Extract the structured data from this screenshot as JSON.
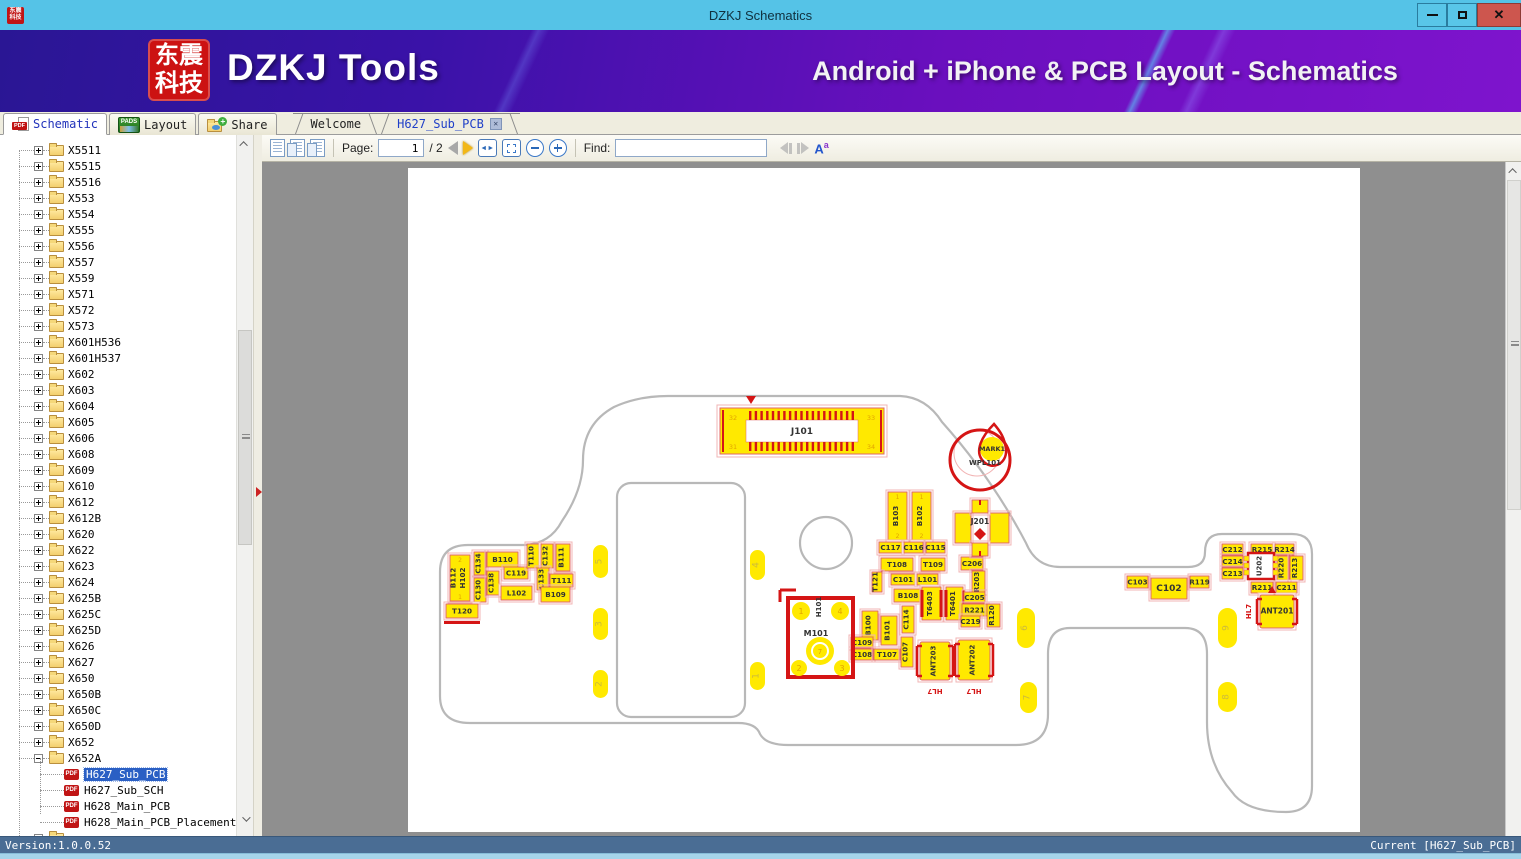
{
  "window": {
    "title": "DZKJ Schematics",
    "logo_line1": "东震",
    "logo_line2": "科技"
  },
  "banner": {
    "app_name": "DZKJ Tools",
    "tagline": "Android + iPhone & PCB Layout - Schematics"
  },
  "icons": {
    "pdf_badge": "PDF",
    "pads_badge": "PADS"
  },
  "tabs": {
    "app": [
      {
        "label": "Schematic",
        "active": true
      },
      {
        "label": "Layout",
        "active": false
      },
      {
        "label": "Share",
        "active": false
      }
    ],
    "docs": [
      {
        "label": "Welcome",
        "active": false,
        "closable": false
      },
      {
        "label": "H627_Sub_PCB",
        "active": true,
        "closable": true
      }
    ]
  },
  "toolbar": {
    "page_label": "Page:",
    "page_value": "1",
    "page_total": "/ 2",
    "find_label": "Find:",
    "find_value": ""
  },
  "sidebar": {
    "folders": [
      "X5511",
      "X5515",
      "X5516",
      "X553",
      "X554",
      "X555",
      "X556",
      "X557",
      "X559",
      "X571",
      "X572",
      "X573",
      "X601H536",
      "X601H537",
      "X602",
      "X603",
      "X604",
      "X605",
      "X606",
      "X608",
      "X609",
      "X610",
      "X612",
      "X612B",
      "X620",
      "X622",
      "X623",
      "X624",
      "X625B",
      "X625C",
      "X625D",
      "X626",
      "X627",
      "X650",
      "X650B",
      "X650C",
      "X650D",
      "X652",
      "X652A"
    ],
    "expanded": "X652A",
    "files": [
      {
        "label": "H627_Sub_PCB",
        "selected": true
      },
      {
        "label": "H627_Sub_SCH",
        "selected": false
      },
      {
        "label": "H628_Main_PCB",
        "selected": false
      },
      {
        "label": "H628_Main_PCB_Placement",
        "selected": false
      }
    ],
    "partial_folder": true
  },
  "statusbar": {
    "left": "Version:1.0.0.52",
    "right": "Current [H627_Sub_PCB]"
  },
  "pcb": {
    "colors": {
      "yellow": "#ffe900",
      "pink": "#e06666",
      "frame": "#f2b4b4",
      "red": "#d51515",
      "text": "#333333",
      "orange": "#e2a400",
      "board": "#b8b8b8",
      "tp_text": "#cdbb3a"
    },
    "outline": {
      "board": "M260,228 H492 Q518,229 534,254 Q584,310 618,375 Q628,399 652,399 H780 Q797,399 797,384 Q797,366 814,366 H884 Q904,366 904,386 V618 Q904,644 878,644 Q838,644 824,624 Q799,596 799,554 V486 Q799,460 777,460 H662 Q640,460 640,486 V546 Q640,577 608,577 H380 Q358,577 352,566 Q348,555 330,555 H62 Q32,555 32,528 V404 Q32,377 60,377 H116 Q142,376 154,353 Q175,322 175,292 Q175,256 206,239 Q230,228 260,228 Z",
      "slot": {
        "x": 209,
        "y": 315,
        "w": 128,
        "h": 234,
        "r": 14
      },
      "hole": {
        "cx": 418,
        "cy": 375,
        "r": 26
      }
    },
    "j101": {
      "label": "J101",
      "pins": [
        "32",
        "33",
        "31",
        "34"
      ],
      "x": 312,
      "y": 240,
      "w": 164,
      "h": 46
    },
    "mark": {
      "line1": "MARK1",
      "line2": "WPL101",
      "cx": 572,
      "cy": 292,
      "r": 30
    },
    "j201": {
      "label": "J201",
      "cx": 572,
      "cy": 359
    },
    "m101": {
      "label": "M101",
      "sub": "H101",
      "x": 380,
      "y": 430,
      "w": 65,
      "h": 79,
      "pads": [
        "1",
        "4",
        "2",
        "3"
      ],
      "center_pad": "7"
    },
    "u202": {
      "label": "U202",
      "x": 840,
      "y": 385,
      "w": 26,
      "h": 26
    },
    "ant": [
      {
        "label": "ANT203",
        "x": 512,
        "y": 474,
        "w": 30,
        "h": 38,
        "hl": "HL7",
        "horizontal": false
      },
      {
        "label": "ANT202",
        "x": 550,
        "y": 472,
        "w": 32,
        "h": 40,
        "hl": "HL7",
        "horizontal": false
      },
      {
        "label": "ANT201",
        "x": 852,
        "y": 427,
        "w": 34,
        "h": 33,
        "hl": "HL7",
        "horizontal": true
      }
    ],
    "components": [
      {
        "l": "B112",
        "l2": "H102",
        "x": 42,
        "y": 387,
        "w": 20,
        "h": 46,
        "o": "v",
        "pins": [
          "2",
          "1"
        ]
      },
      {
        "l": "C134",
        "x": 66,
        "y": 384,
        "w": 12,
        "h": 23,
        "o": "v"
      },
      {
        "l": "C130",
        "x": 66,
        "y": 410,
        "w": 12,
        "h": 24,
        "o": "v"
      },
      {
        "l": "C138",
        "x": 79,
        "y": 403,
        "w": 12,
        "h": 24,
        "o": "v"
      },
      {
        "l": "B110",
        "x": 79,
        "y": 384,
        "w": 31,
        "h": 15,
        "o": "h"
      },
      {
        "l": "C119",
        "x": 96,
        "y": 399,
        "w": 24,
        "h": 12,
        "o": "h"
      },
      {
        "l": "L102",
        "x": 93,
        "y": 418,
        "w": 31,
        "h": 14,
        "o": "h"
      },
      {
        "l": "T110",
        "x": 119,
        "y": 376,
        "w": 12,
        "h": 24,
        "o": "v"
      },
      {
        "l": "C132",
        "x": 133,
        "y": 376,
        "w": 12,
        "h": 24,
        "o": "v"
      },
      {
        "l": "B111",
        "x": 148,
        "y": 376,
        "w": 14,
        "h": 27,
        "o": "v"
      },
      {
        "l": "C133",
        "x": 129,
        "y": 400,
        "w": 12,
        "h": 22,
        "o": "v"
      },
      {
        "l": "T111",
        "x": 142,
        "y": 406,
        "w": 23,
        "h": 13,
        "o": "h"
      },
      {
        "l": "B109",
        "x": 133,
        "y": 419,
        "w": 29,
        "h": 15,
        "o": "h"
      },
      {
        "l": "T120",
        "x": 38,
        "y": 436,
        "w": 32,
        "h": 14,
        "o": "h",
        "s": "underline"
      },
      {
        "l": "B103",
        "x": 480,
        "y": 324,
        "w": 19,
        "h": 48,
        "o": "v",
        "pins": [
          "1",
          "2"
        ]
      },
      {
        "l": "B102",
        "x": 504,
        "y": 324,
        "w": 19,
        "h": 48,
        "o": "v",
        "pins": [
          "1",
          "2"
        ]
      },
      {
        "l": "C117",
        "x": 471,
        "y": 374,
        "w": 23,
        "h": 11,
        "o": "h"
      },
      {
        "l": "C116",
        "x": 496,
        "y": 374,
        "w": 19,
        "h": 11,
        "o": "h"
      },
      {
        "l": "C115",
        "x": 518,
        "y": 374,
        "w": 19,
        "h": 11,
        "o": "h"
      },
      {
        "l": "T108",
        "x": 473,
        "y": 390,
        "w": 32,
        "h": 13,
        "o": "h"
      },
      {
        "l": "T109",
        "x": 513,
        "y": 390,
        "w": 24,
        "h": 13,
        "o": "h"
      },
      {
        "l": "T121",
        "x": 464,
        "y": 404,
        "w": 10,
        "h": 20,
        "o": "v"
      },
      {
        "l": "C101",
        "x": 483,
        "y": 406,
        "w": 24,
        "h": 11,
        "o": "h"
      },
      {
        "l": "L101",
        "x": 509,
        "y": 406,
        "w": 21,
        "h": 11,
        "o": "h"
      },
      {
        "l": "B108",
        "x": 486,
        "y": 421,
        "w": 28,
        "h": 13,
        "o": "h"
      },
      {
        "l": "T6403",
        "x": 514,
        "y": 419,
        "w": 19,
        "h": 33,
        "o": "v",
        "s": "bars"
      },
      {
        "l": "T6401",
        "x": 538,
        "y": 419,
        "w": 17,
        "h": 33,
        "o": "v",
        "s": "bars"
      },
      {
        "l": "C206",
        "x": 553,
        "y": 389,
        "w": 22,
        "h": 13,
        "o": "h"
      },
      {
        "l": "R203",
        "x": 564,
        "y": 403,
        "w": 13,
        "h": 22,
        "o": "v"
      },
      {
        "l": "C205",
        "x": 556,
        "y": 424,
        "w": 21,
        "h": 11,
        "o": "h"
      },
      {
        "l": "R221",
        "x": 554,
        "y": 436,
        "w": 25,
        "h": 12,
        "o": "h"
      },
      {
        "l": "C219",
        "x": 553,
        "y": 448,
        "w": 19,
        "h": 11,
        "o": "h"
      },
      {
        "l": "R120",
        "x": 579,
        "y": 436,
        "w": 13,
        "h": 23,
        "o": "v"
      },
      {
        "l": "C114",
        "x": 494,
        "y": 438,
        "w": 12,
        "h": 27,
        "o": "v"
      },
      {
        "l": "B100",
        "x": 454,
        "y": 443,
        "w": 16,
        "h": 29,
        "o": "v"
      },
      {
        "l": "B101",
        "x": 473,
        "y": 448,
        "w": 16,
        "h": 29,
        "o": "v"
      },
      {
        "l": "C109",
        "x": 443,
        "y": 469,
        "w": 22,
        "h": 11,
        "o": "h"
      },
      {
        "l": "C108",
        "x": 443,
        "y": 481,
        "w": 22,
        "h": 11,
        "o": "h"
      },
      {
        "l": "T107",
        "x": 466,
        "y": 481,
        "w": 26,
        "h": 11,
        "o": "h"
      },
      {
        "l": "C107",
        "x": 493,
        "y": 469,
        "w": 12,
        "h": 30,
        "o": "v"
      },
      {
        "l": "C103",
        "x": 719,
        "y": 408,
        "w": 21,
        "h": 12,
        "o": "h"
      },
      {
        "l": "C102",
        "x": 743,
        "y": 410,
        "w": 36,
        "h": 21,
        "o": "h",
        "s": "big"
      },
      {
        "l": "R119",
        "x": 782,
        "y": 408,
        "w": 19,
        "h": 12,
        "o": "h"
      },
      {
        "l": "C212",
        "x": 814,
        "y": 376,
        "w": 21,
        "h": 11,
        "o": "h"
      },
      {
        "l": "R215",
        "x": 843,
        "y": 376,
        "w": 22,
        "h": 11,
        "o": "h"
      },
      {
        "l": "R214",
        "x": 867,
        "y": 376,
        "w": 19,
        "h": 11,
        "o": "h"
      },
      {
        "l": "C214",
        "x": 814,
        "y": 388,
        "w": 21,
        "h": 11,
        "o": "h"
      },
      {
        "l": "C213",
        "x": 814,
        "y": 400,
        "w": 21,
        "h": 11,
        "o": "h"
      },
      {
        "l": "R220",
        "x": 869,
        "y": 388,
        "w": 12,
        "h": 24,
        "o": "v"
      },
      {
        "l": "R213",
        "x": 882,
        "y": 388,
        "w": 13,
        "h": 24,
        "o": "v"
      },
      {
        "l": "R211",
        "x": 843,
        "y": 414,
        "w": 22,
        "h": 11,
        "o": "h"
      },
      {
        "l": "C211",
        "x": 868,
        "y": 414,
        "w": 21,
        "h": 11,
        "o": "h"
      }
    ],
    "test_points": [
      {
        "n": "5",
        "x": 185,
        "y": 377,
        "w": 15,
        "h": 33
      },
      {
        "n": "3",
        "x": 185,
        "y": 440,
        "w": 15,
        "h": 32
      },
      {
        "n": "2",
        "x": 185,
        "y": 502,
        "w": 15,
        "h": 28
      },
      {
        "n": "4",
        "x": 342,
        "y": 382,
        "w": 15,
        "h": 30
      },
      {
        "n": "1",
        "x": 342,
        "y": 494,
        "w": 15,
        "h": 28
      },
      {
        "n": "6",
        "x": 609,
        "y": 440,
        "w": 18,
        "h": 40
      },
      {
        "n": "7",
        "x": 612,
        "y": 514,
        "w": 17,
        "h": 31
      },
      {
        "n": "9",
        "x": 810,
        "y": 440,
        "w": 19,
        "h": 40
      },
      {
        "n": "8",
        "x": 810,
        "y": 514,
        "w": 19,
        "h": 30
      }
    ]
  }
}
